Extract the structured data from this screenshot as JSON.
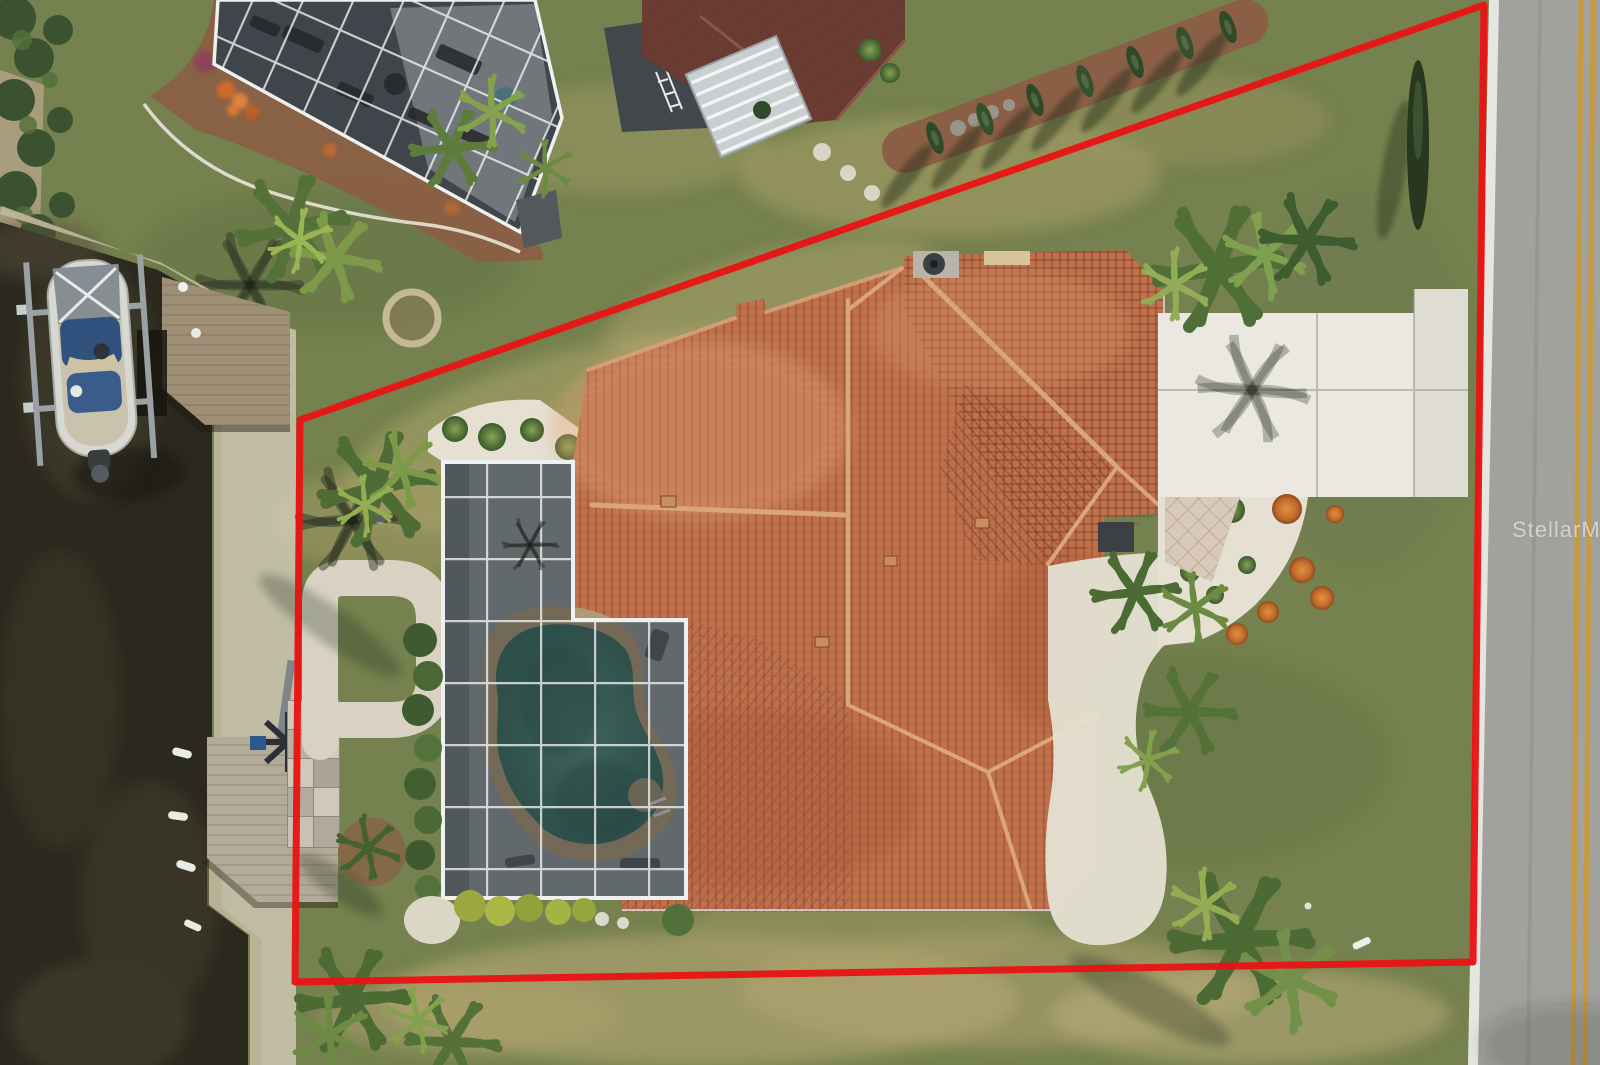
{
  "watermark": {
    "text": "StellarMLS"
  },
  "colors": {
    "boundary_red": "#e81414",
    "grass_base": "#75814e",
    "grass_dry": "#b9aa72",
    "canal_water": "#2b281e",
    "roof_tile": "#c0714c",
    "roof_ridge": "#dba57c",
    "neighbor_roof": "#6a3d33",
    "screen_dark": "#3f454b",
    "frame_white": "#eef1ef",
    "pool_water": "#4a8173",
    "pool_coping": "#b09a75",
    "deck_gray": "#939a9c",
    "driveway": "#eae8e0",
    "gravel_white": "#e5e0d2",
    "mulch_brown": "#8a5f45",
    "road_asphalt": "#a1a19d",
    "road_yellow": "#c89a3e",
    "concrete_walk": "#d9d2c2",
    "boat_blue": "#31517e"
  }
}
